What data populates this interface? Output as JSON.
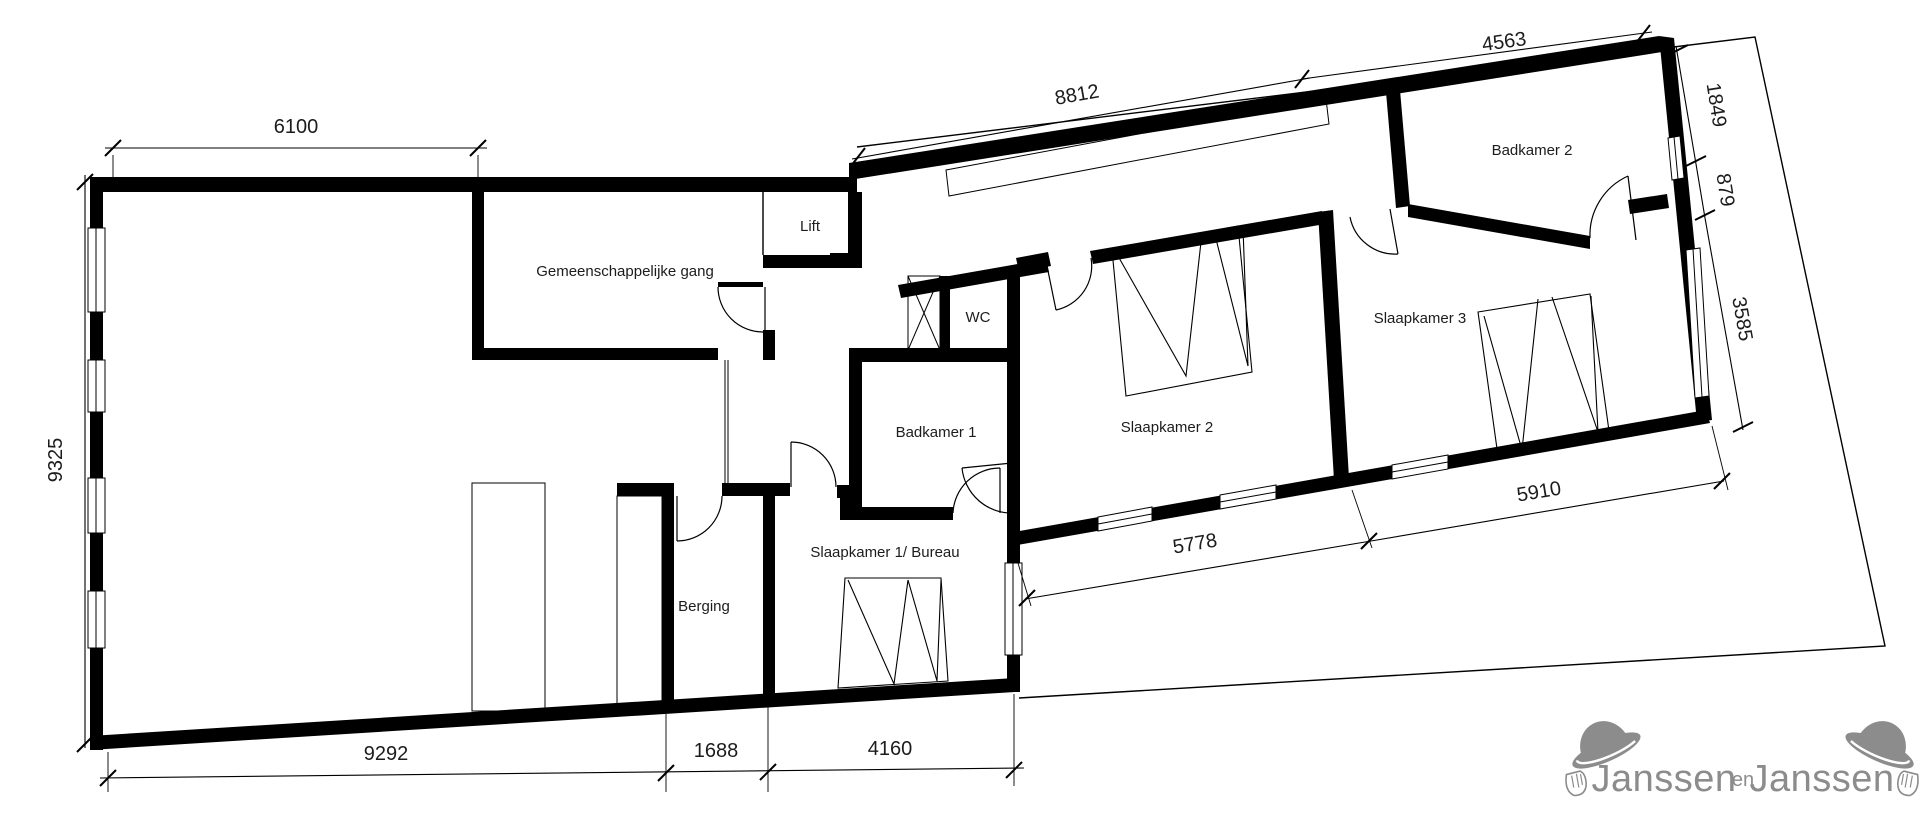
{
  "plan": {
    "title": "floor-plan",
    "rooms": [
      {
        "id": "gemeenschappelijke-gang",
        "label": "Gemeenschappelijke gang"
      },
      {
        "id": "lift",
        "label": "Lift"
      },
      {
        "id": "wc",
        "label": "WC"
      },
      {
        "id": "badkamer-1",
        "label": "Badkamer 1"
      },
      {
        "id": "slaapkamer-1-bureau",
        "label": "Slaapkamer 1/ Bureau"
      },
      {
        "id": "berging",
        "label": "Berging"
      },
      {
        "id": "slaapkamer-2",
        "label": "Slaapkamer 2"
      },
      {
        "id": "slaapkamer-3",
        "label": "Slaapkamer 3"
      },
      {
        "id": "badkamer-2",
        "label": "Badkamer 2"
      }
    ],
    "dimensions_mm": [
      {
        "id": "top-left-width",
        "value": "6100"
      },
      {
        "id": "left-height",
        "value": "9325"
      },
      {
        "id": "bottom-left",
        "value": "9292"
      },
      {
        "id": "bottom-middle",
        "value": "1688"
      },
      {
        "id": "bottom-right",
        "value": "4160"
      },
      {
        "id": "wing-top",
        "value": "8812"
      },
      {
        "id": "wing-top-right",
        "value": "4563"
      },
      {
        "id": "right-upper",
        "value": "1849"
      },
      {
        "id": "right-middle",
        "value": "879"
      },
      {
        "id": "right-lower",
        "value": "3585"
      },
      {
        "id": "wing-bottom-left",
        "value": "5778"
      },
      {
        "id": "wing-bottom-right",
        "value": "5910"
      }
    ]
  },
  "logo": {
    "word_1": "Janssen",
    "word_2": "en",
    "word_3": "Janssen"
  },
  "colors": {
    "walls": "#000000",
    "background": "#ffffff",
    "logo_gray": "#8c8c8c"
  }
}
